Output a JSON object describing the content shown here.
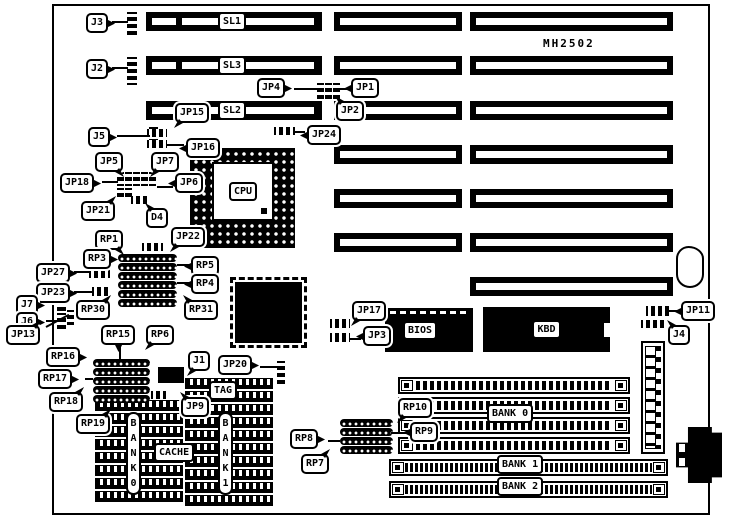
{
  "title": {
    "board_id": "MH2502"
  },
  "chips": {
    "cpu_label": "CPU",
    "bios_label": "BIOS",
    "kbd_label": "KBD"
  },
  "slot_labels": [
    "SL1",
    "SL3",
    "SL2"
  ],
  "callouts": [
    {
      "t": "J3",
      "x": 86,
      "y": 13,
      "d": "r"
    },
    {
      "t": "J2",
      "x": 86,
      "y": 59,
      "d": "r"
    },
    {
      "t": "J5",
      "x": 88,
      "y": 127,
      "d": "r"
    },
    {
      "t": "JP15",
      "x": 175,
      "y": 103,
      "d": "bl"
    },
    {
      "t": "JP16",
      "x": 186,
      "y": 138,
      "d": "l"
    },
    {
      "t": "JP24",
      "x": 307,
      "y": 125,
      "d": "l"
    },
    {
      "t": "JP4",
      "x": 257,
      "y": 78,
      "d": "r"
    },
    {
      "t": "JP1",
      "x": 351,
      "y": 78,
      "d": "l"
    },
    {
      "t": "JP2",
      "x": 336,
      "y": 101,
      "d": "tl"
    },
    {
      "t": "JP5",
      "x": 95,
      "y": 152,
      "d": "br"
    },
    {
      "t": "JP7",
      "x": 151,
      "y": 152,
      "d": "bl"
    },
    {
      "t": "JP18",
      "x": 60,
      "y": 173,
      "d": "r"
    },
    {
      "t": "JP6",
      "x": 175,
      "y": 173,
      "d": "l"
    },
    {
      "t": "JP21",
      "x": 81,
      "y": 201,
      "d": "tr"
    },
    {
      "t": "D4",
      "x": 146,
      "y": 208,
      "d": "tl"
    },
    {
      "t": "JP22",
      "x": 171,
      "y": 227,
      "d": "bl"
    },
    {
      "t": "RP1",
      "x": 95,
      "y": 230,
      "d": "br"
    },
    {
      "t": "RP3",
      "x": 83,
      "y": 249,
      "d": "r"
    },
    {
      "t": "RP5",
      "x": 191,
      "y": 256,
      "d": "l"
    },
    {
      "t": "RP4",
      "x": 191,
      "y": 274,
      "d": "l"
    },
    {
      "t": "JP27",
      "x": 36,
      "y": 263,
      "d": "r"
    },
    {
      "t": "JP23",
      "x": 36,
      "y": 283,
      "d": "r"
    },
    {
      "t": "J7",
      "x": 16,
      "y": 295,
      "d": "r"
    },
    {
      "t": "J6",
      "x": 16,
      "y": 312,
      "d": "r"
    },
    {
      "t": "RP30",
      "x": 76,
      "y": 300,
      "d": "tr"
    },
    {
      "t": "RP31",
      "x": 184,
      "y": 300,
      "d": "tl"
    },
    {
      "t": "JP13",
      "x": 6,
      "y": 325,
      "d": "tr"
    },
    {
      "t": "RP15",
      "x": 101,
      "y": 325,
      "d": "b"
    },
    {
      "t": "RP6",
      "x": 146,
      "y": 325,
      "d": "bl"
    },
    {
      "t": "RP16",
      "x": 46,
      "y": 347,
      "d": "r"
    },
    {
      "t": "RP17",
      "x": 38,
      "y": 369,
      "d": "r"
    },
    {
      "t": "RP18",
      "x": 49,
      "y": 392,
      "d": "tr"
    },
    {
      "t": "RP19",
      "x": 76,
      "y": 414,
      "d": "tr"
    },
    {
      "t": "J1",
      "x": 188,
      "y": 351,
      "d": "bl"
    },
    {
      "t": "JP20",
      "x": 218,
      "y": 355,
      "d": "r"
    },
    {
      "t": "JP9",
      "x": 181,
      "y": 397,
      "d": "tl"
    },
    {
      "t": "JP17",
      "x": 352,
      "y": 301,
      "d": "bl"
    },
    {
      "t": "JP3",
      "x": 363,
      "y": 326,
      "d": "l"
    },
    {
      "t": "JP11",
      "x": 681,
      "y": 301,
      "d": "l"
    },
    {
      "t": "J4",
      "x": 668,
      "y": 325,
      "d": "tl"
    },
    {
      "t": "RP10",
      "x": 398,
      "y": 398,
      "d": "bl"
    },
    {
      "t": "RP9",
      "x": 410,
      "y": 422,
      "d": "l"
    },
    {
      "t": "RP8",
      "x": 290,
      "y": 429,
      "d": "r"
    },
    {
      "t": "RP7",
      "x": 301,
      "y": 454,
      "d": "tr"
    }
  ],
  "plates": [
    {
      "t": "SL1",
      "x": 218,
      "y": 12
    },
    {
      "t": "SL3",
      "x": 218,
      "y": 56
    },
    {
      "t": "SL2",
      "x": 218,
      "y": 101
    },
    {
      "t": "TAG",
      "x": 209,
      "y": 381
    },
    {
      "t": "CACHE",
      "x": 154,
      "y": 443
    },
    {
      "t": "BANK 0",
      "x": 487,
      "y": 404
    },
    {
      "t": "BANK 1",
      "x": 497,
      "y": 455
    },
    {
      "t": "BANK 2",
      "x": 497,
      "y": 477
    },
    {
      "t": "BANK0",
      "x": 126,
      "y": 412,
      "cls": "vert"
    },
    {
      "t": "BANK1",
      "x": 218,
      "y": 412,
      "cls": "vert"
    }
  ],
  "components": {
    "slots": [
      {
        "x": 146,
        "y": 12,
        "w": 176,
        "h": 19,
        "v": "isa"
      },
      {
        "x": 146,
        "y": 56,
        "w": 176,
        "h": 19,
        "v": "isa"
      },
      {
        "x": 146,
        "y": 101,
        "w": 176,
        "h": 19,
        "v": "isa"
      },
      {
        "x": 334,
        "y": 12,
        "w": 128,
        "h": 19,
        "v": "p"
      },
      {
        "x": 334,
        "y": 56,
        "w": 128,
        "h": 19,
        "v": "p"
      },
      {
        "x": 334,
        "y": 101,
        "w": 128,
        "h": 19,
        "v": "p"
      },
      {
        "x": 334,
        "y": 145,
        "w": 128,
        "h": 19,
        "v": "p"
      },
      {
        "x": 334,
        "y": 189,
        "w": 128,
        "h": 19,
        "v": "p"
      },
      {
        "x": 334,
        "y": 233,
        "w": 128,
        "h": 19,
        "v": "p"
      },
      {
        "x": 470,
        "y": 12,
        "w": 203,
        "h": 19,
        "v": "p"
      },
      {
        "x": 470,
        "y": 56,
        "w": 203,
        "h": 19,
        "v": "p"
      },
      {
        "x": 470,
        "y": 101,
        "w": 203,
        "h": 19,
        "v": "p"
      },
      {
        "x": 470,
        "y": 145,
        "w": 203,
        "h": 19,
        "v": "p"
      },
      {
        "x": 470,
        "y": 189,
        "w": 203,
        "h": 19,
        "v": "p"
      },
      {
        "x": 470,
        "y": 233,
        "w": 203,
        "h": 19,
        "v": "p"
      },
      {
        "x": 470,
        "y": 277,
        "w": 203,
        "h": 19,
        "v": "p"
      }
    ],
    "jumpers": [
      {
        "n": "j3-connector",
        "x": 127,
        "y": 12,
        "w": 10,
        "h": 26,
        "d": "v"
      },
      {
        "n": "j2-connector",
        "x": 127,
        "y": 57,
        "w": 10,
        "h": 28,
        "d": "v"
      },
      {
        "n": "j5-connector",
        "x": 149,
        "y": 127,
        "w": 9,
        "h": 19,
        "d": "v"
      },
      {
        "n": "jp15-block",
        "x": 147,
        "y": 129,
        "w": 20,
        "h": 8,
        "d": "h"
      },
      {
        "n": "jp16-block",
        "x": 147,
        "y": 140,
        "w": 20,
        "h": 8,
        "d": "h"
      },
      {
        "n": "jp24-block",
        "x": 274,
        "y": 127,
        "w": 21,
        "h": 8,
        "d": "h"
      },
      {
        "n": "jp4-block",
        "x": 317,
        "y": 83,
        "w": 7,
        "h": 17,
        "d": "v"
      },
      {
        "n": "jp1-block-a",
        "x": 325,
        "y": 83,
        "w": 7,
        "h": 17,
        "d": "v"
      },
      {
        "n": "jp1-block-b",
        "x": 333,
        "y": 83,
        "w": 7,
        "h": 17,
        "d": "v"
      },
      {
        "n": "cpu-jumper-1",
        "x": 117,
        "y": 172,
        "w": 7,
        "h": 14,
        "d": "v"
      },
      {
        "n": "cpu-jumper-2",
        "x": 125,
        "y": 172,
        "w": 7,
        "h": 14,
        "d": "v"
      },
      {
        "n": "cpu-jumper-3",
        "x": 133,
        "y": 172,
        "w": 7,
        "h": 14,
        "d": "v"
      },
      {
        "n": "cpu-jumper-4",
        "x": 141,
        "y": 172,
        "w": 7,
        "h": 14,
        "d": "v"
      },
      {
        "n": "cpu-jumper-5",
        "x": 149,
        "y": 172,
        "w": 7,
        "h": 14,
        "d": "v"
      },
      {
        "n": "jp21-block-a",
        "x": 117,
        "y": 188,
        "w": 7,
        "h": 10,
        "d": "v"
      },
      {
        "n": "jp21-block-b",
        "x": 125,
        "y": 188,
        "w": 7,
        "h": 10,
        "d": "v"
      },
      {
        "n": "d4-component",
        "x": 131,
        "y": 196,
        "w": 17,
        "h": 8,
        "d": "h"
      },
      {
        "n": "jp22-block",
        "x": 142,
        "y": 243,
        "w": 21,
        "h": 8,
        "d": "h"
      },
      {
        "n": "jp27-block",
        "x": 89,
        "y": 268,
        "w": 21,
        "h": 10,
        "d": "h"
      },
      {
        "n": "jp23-block",
        "x": 92,
        "y": 287,
        "w": 19,
        "h": 9,
        "d": "h"
      },
      {
        "n": "j7-connector",
        "x": 57,
        "y": 295,
        "w": 9,
        "h": 17,
        "d": "v"
      },
      {
        "n": "j6-connector",
        "x": 57,
        "y": 313,
        "w": 9,
        "h": 16,
        "d": "v"
      },
      {
        "n": "j6-aux-connector",
        "x": 67,
        "y": 310,
        "w": 7,
        "h": 15,
        "d": "v"
      },
      {
        "n": "jp9-block",
        "x": 151,
        "y": 391,
        "w": 15,
        "h": 8,
        "d": "h"
      },
      {
        "n": "jp20-connector",
        "x": 277,
        "y": 361,
        "w": 8,
        "h": 23,
        "d": "v"
      },
      {
        "n": "jp17-block",
        "x": 330,
        "y": 319,
        "w": 20,
        "h": 9,
        "d": "h"
      },
      {
        "n": "jp3-block",
        "x": 330,
        "y": 333,
        "w": 20,
        "h": 9,
        "d": "h"
      },
      {
        "n": "jp11-block",
        "x": 646,
        "y": 306,
        "w": 24,
        "h": 10,
        "d": "h"
      },
      {
        "n": "j4-connector",
        "x": 641,
        "y": 320,
        "w": 26,
        "h": 8,
        "d": "h"
      }
    ],
    "sips": [
      {
        "x": 118,
        "y": 254,
        "w": 59
      },
      {
        "x": 118,
        "y": 263,
        "w": 59
      },
      {
        "x": 118,
        "y": 272,
        "w": 59
      },
      {
        "x": 118,
        "y": 281,
        "w": 59
      },
      {
        "x": 118,
        "y": 290,
        "w": 59
      },
      {
        "x": 118,
        "y": 299,
        "w": 59
      },
      {
        "x": 93,
        "y": 359,
        "w": 57
      },
      {
        "x": 93,
        "y": 368,
        "w": 57
      },
      {
        "x": 93,
        "y": 377,
        "w": 57
      },
      {
        "x": 93,
        "y": 386,
        "w": 57
      },
      {
        "x": 93,
        "y": 395,
        "w": 57
      },
      {
        "x": 340,
        "y": 419,
        "w": 53
      },
      {
        "x": 340,
        "y": 428,
        "w": 53
      },
      {
        "x": 340,
        "y": 437,
        "w": 53
      },
      {
        "x": 340,
        "y": 446,
        "w": 53
      }
    ],
    "dips": [
      {
        "x": 95,
        "y": 400,
        "w": 88
      },
      {
        "x": 95,
        "y": 413,
        "w": 88
      },
      {
        "x": 95,
        "y": 426,
        "w": 88
      },
      {
        "x": 95,
        "y": 439,
        "w": 88
      },
      {
        "x": 95,
        "y": 452,
        "w": 88
      },
      {
        "x": 95,
        "y": 465,
        "w": 88
      },
      {
        "x": 95,
        "y": 478,
        "w": 88
      },
      {
        "x": 95,
        "y": 491,
        "w": 88
      },
      {
        "x": 185,
        "y": 378,
        "w": 88
      },
      {
        "x": 185,
        "y": 391,
        "w": 88
      },
      {
        "x": 185,
        "y": 404,
        "w": 88
      },
      {
        "x": 185,
        "y": 417,
        "w": 88
      },
      {
        "x": 185,
        "y": 430,
        "w": 88
      },
      {
        "x": 185,
        "y": 443,
        "w": 88
      },
      {
        "x": 185,
        "y": 456,
        "w": 88
      },
      {
        "x": 185,
        "y": 469,
        "w": 88
      },
      {
        "x": 185,
        "y": 482,
        "w": 88
      },
      {
        "x": 185,
        "y": 495,
        "w": 88
      }
    ],
    "simms": [
      {
        "x": 398,
        "y": 377,
        "w": 232,
        "fine": false
      },
      {
        "x": 398,
        "y": 397,
        "w": 232,
        "fine": false
      },
      {
        "x": 398,
        "y": 417,
        "w": 232,
        "fine": false
      },
      {
        "x": 398,
        "y": 437,
        "w": 232,
        "fine": false
      },
      {
        "x": 389,
        "y": 459,
        "w": 279,
        "fine": true
      },
      {
        "x": 389,
        "y": 481,
        "w": 279,
        "fine": true
      }
    ],
    "j1_grid": {
      "x": 158,
      "y": 367,
      "w": 26,
      "h": 16
    },
    "leaders": [
      [
        112,
        21,
        16,
        2
      ],
      [
        112,
        67,
        16,
        2
      ],
      [
        117,
        135,
        33,
        2
      ],
      [
        294,
        88,
        23,
        2
      ],
      [
        340,
        88,
        12,
        2
      ],
      [
        295,
        131,
        13,
        2
      ],
      [
        166,
        144,
        21,
        2
      ],
      [
        102,
        181,
        16,
        2
      ],
      [
        157,
        186,
        19,
        2
      ],
      [
        177,
        264,
        14,
        2
      ],
      [
        177,
        282,
        14,
        2
      ],
      [
        74,
        271,
        16,
        2
      ],
      [
        74,
        291,
        18,
        2
      ],
      [
        46,
        303,
        11,
        2
      ],
      [
        46,
        320,
        11,
        2
      ],
      [
        85,
        378,
        8,
        2
      ],
      [
        119,
        346,
        2,
        14
      ],
      [
        260,
        366,
        17,
        2
      ],
      [
        350,
        338,
        13,
        2
      ],
      [
        669,
        310,
        12,
        2
      ],
      [
        391,
        432,
        19,
        2
      ],
      [
        328,
        440,
        12,
        2
      ],
      [
        46,
        326,
        26,
        2,
        -28
      ]
    ]
  }
}
